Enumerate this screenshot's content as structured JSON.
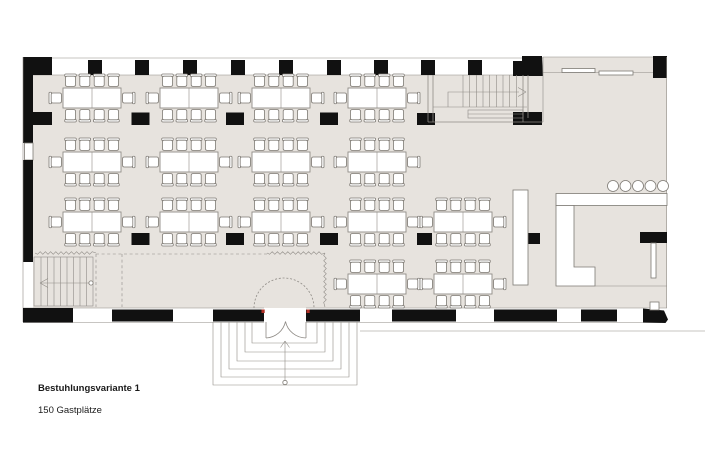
{
  "caption": {
    "title": "Bestuhlungsvariante 1",
    "subtitle": "150 Gastplätze"
  },
  "colors": {
    "floor": "#e7e3de",
    "wall": "#111111",
    "line": "#8f8b86",
    "accent": "#b03026"
  },
  "furniture": {
    "tables": {
      "w": 58,
      "h": 20,
      "chairs_per_table": 10,
      "count": 15,
      "positions": [
        [
          92,
          98
        ],
        [
          189,
          98
        ],
        [
          281,
          98
        ],
        [
          377,
          98
        ],
        [
          92,
          162
        ],
        [
          189,
          162
        ],
        [
          281,
          162
        ],
        [
          377,
          162
        ],
        [
          92,
          222
        ],
        [
          189,
          222
        ],
        [
          281,
          222
        ],
        [
          377,
          222
        ],
        [
          463,
          222
        ],
        [
          377,
          284
        ],
        [
          463,
          284
        ]
      ]
    },
    "stools": {
      "cy": 186,
      "r": 5.5,
      "cx": [
        613,
        625.5,
        638,
        650.5,
        663
      ]
    }
  },
  "markings": {
    "zigzags": [
      [
        35,
        253,
        96,
        253
      ],
      [
        267,
        253,
        325,
        253
      ],
      [
        325,
        253,
        325,
        307
      ]
    ]
  }
}
